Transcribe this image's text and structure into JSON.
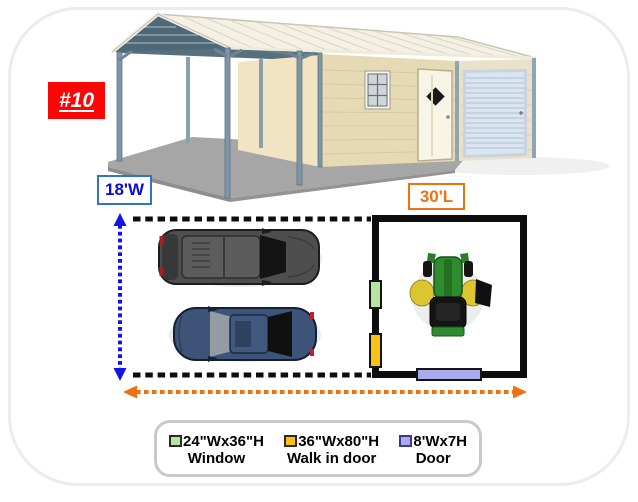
{
  "unit_label": "#10",
  "badge": {
    "bg": "#fb0505",
    "text_color": "#ffffff"
  },
  "dimensions": {
    "width_label": "18'W",
    "width_text_color": "#0a0ae0",
    "width_border_color": "#2e75c8",
    "length_label": "30'L",
    "length_text_color": "#ee7112",
    "length_border_color": "#ee7112"
  },
  "legend": {
    "items": [
      {
        "size": "24\"Wx36\"H",
        "label": "Window",
        "swatch_color": "#b9e3a3",
        "swatch_border": "#2a2a2a"
      },
      {
        "size": "36\"Wx80\"H",
        "label": "Walk in door",
        "swatch_color": "#fdc113",
        "swatch_border": "#2a2a2a"
      },
      {
        "size": "8'Wx7H",
        "label": "Door",
        "swatch_color": "#a9aaec",
        "swatch_border": "#3c3c8c"
      }
    ]
  },
  "floor_plan": {
    "markers": {
      "window": {
        "color": "#b9e3a3"
      },
      "walk_in_door": {
        "color": "#fdc113"
      },
      "garage_door": {
        "color": "#a9aaec"
      }
    },
    "outline_color": "#0d0d0d",
    "width_arrow_color": "#1414e8",
    "length_arrow_color": "#ee7112"
  }
}
